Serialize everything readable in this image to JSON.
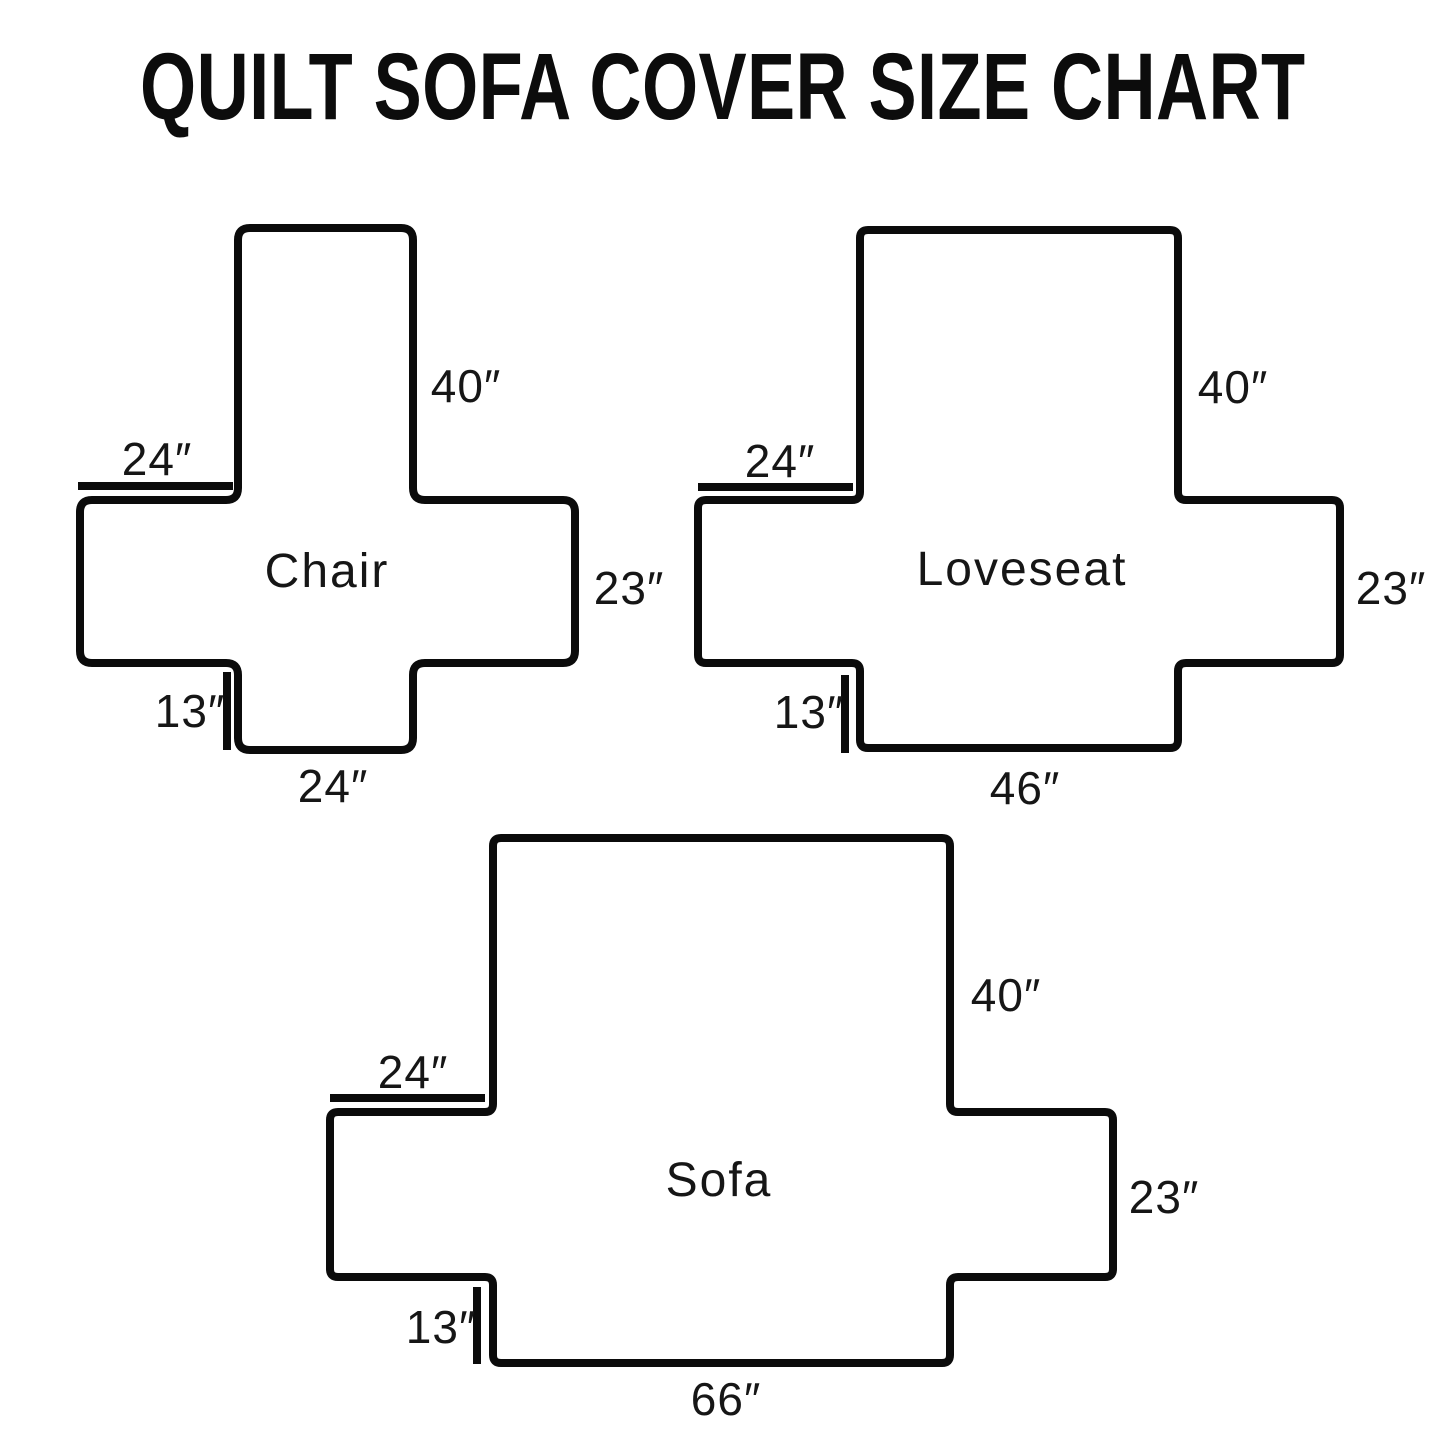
{
  "title": "QUILT SOFA COVER SIZE CHART",
  "colors": {
    "line": "#0b0b0b",
    "text": "#161616",
    "background": "#ffffff"
  },
  "diagrams": [
    {
      "name": "Chair",
      "dims": {
        "back_height": "40″",
        "arm_top_width": "24″",
        "side_height": "23″",
        "flap_depth": "13″",
        "bottom_width": "24″"
      }
    },
    {
      "name": "Loveseat",
      "dims": {
        "back_height": "40″",
        "arm_top_width": "24″",
        "side_height": "23″",
        "flap_depth": "13″",
        "bottom_width": "46″"
      }
    },
    {
      "name": "Sofa",
      "dims": {
        "back_height": "40″",
        "arm_top_width": "24″",
        "side_height": "23″",
        "flap_depth": "13″",
        "bottom_width": "66″"
      }
    }
  ]
}
